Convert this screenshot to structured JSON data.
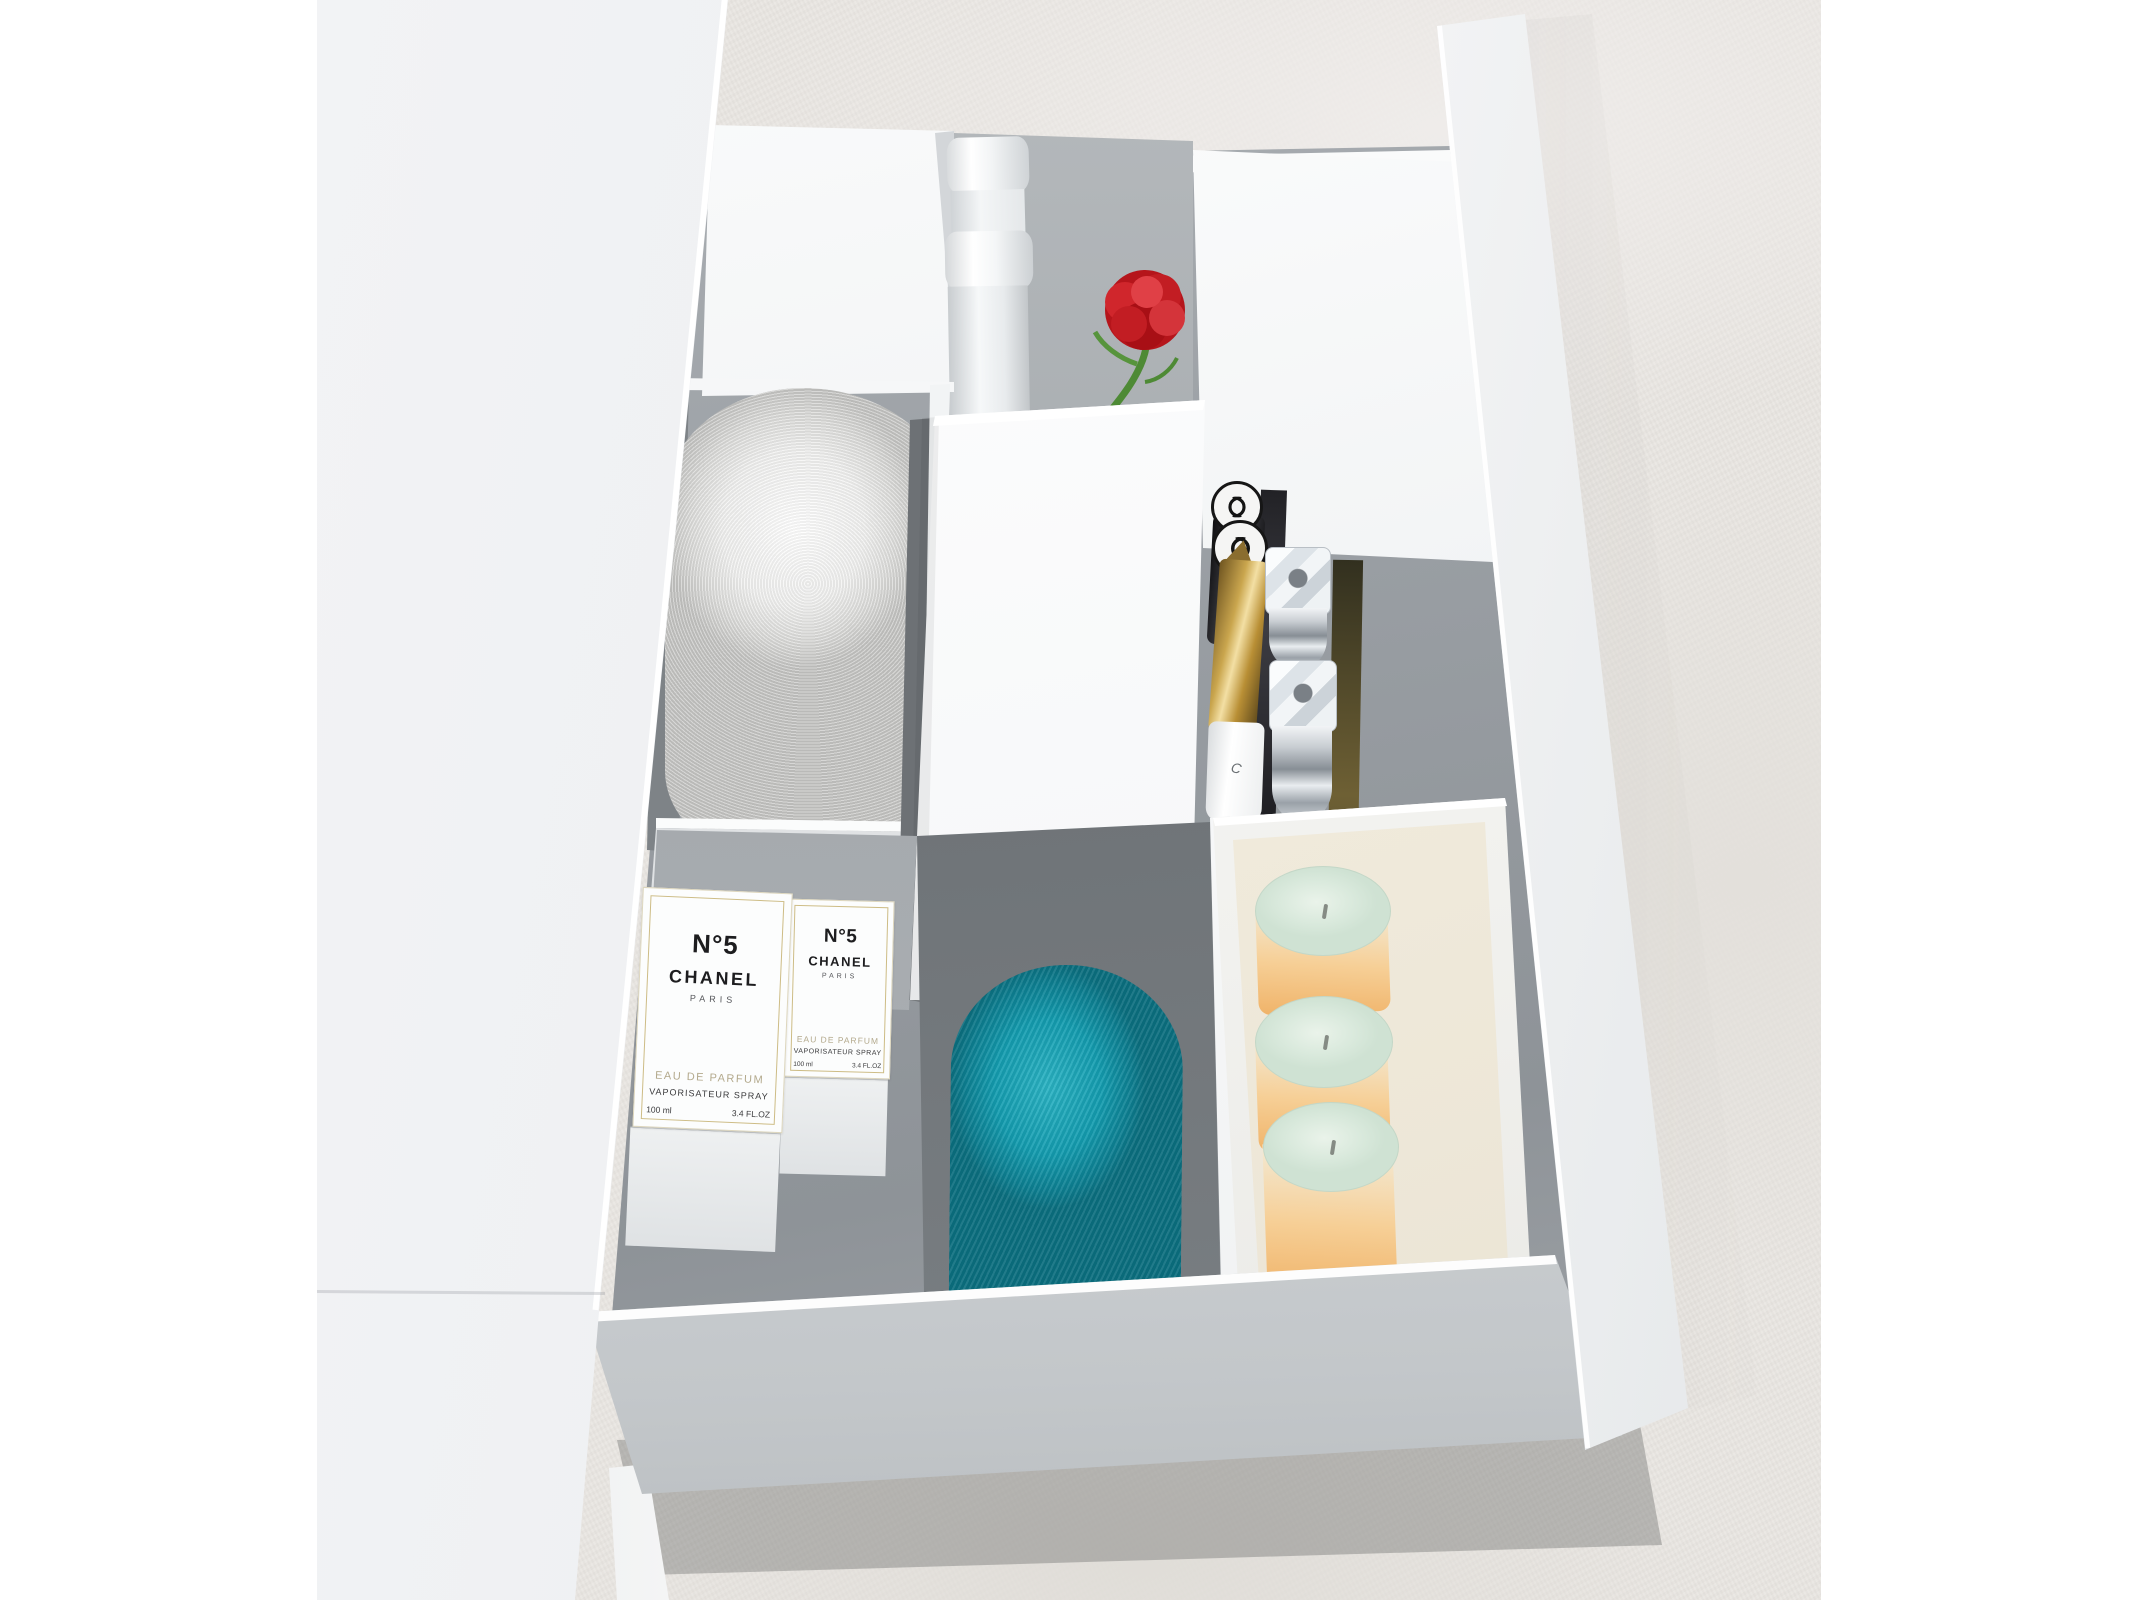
{
  "scene": {
    "type": "product-photograph",
    "subject": "White vanity dressing table with raised lid and open organizer drawer seen from above",
    "background": {
      "floor": "concrete",
      "floor_color": "#e9e6e2",
      "margin_color": "#ffffff"
    },
    "furniture_color": "#f2f3f5",
    "drawer_interior_color": "#9aa0a5"
  },
  "perfume_box": {
    "number": "N°5",
    "brand": "CHANEL",
    "city": "PARIS",
    "product": "EAU DE PARFUM",
    "dispenser": "VAPORISATEUR SPRAY",
    "volume_ml": "100 ml",
    "volume_oz": "3.4 FL.OZ"
  },
  "gloss_tube": {
    "partial_label": "C"
  },
  "objects": [
    {
      "name": "rolled white towel",
      "color": "#ececea"
    },
    {
      "name": "rolled teal towel",
      "color": "#149fb2"
    },
    {
      "name": "white cosmetic bottles",
      "count": 2,
      "color": "#f4f5f6"
    },
    {
      "name": "red carnation flower",
      "petal_color": "#c2181e",
      "stem_color": "#4e8a35"
    },
    {
      "name": "chanel lipsticks with cc logo caps",
      "count": 2,
      "color": "#141416"
    },
    {
      "name": "gold cosmetic tube",
      "color": "#c9a24a"
    },
    {
      "name": "white gloss tube",
      "color": "#f1f2f3"
    },
    {
      "name": "crystal bangles",
      "count": 2,
      "band_color": "#c9ced2",
      "charm_color": "#e6eaed"
    },
    {
      "name": "pillar candles",
      "count": 3,
      "top_color": "#dcebdd",
      "glow_color": "#f0b36a"
    },
    {
      "name": "chanel n°5 perfume boxes",
      "count": 2,
      "color": "#fcfcfb",
      "frame_color": "#cdbc85"
    }
  ]
}
